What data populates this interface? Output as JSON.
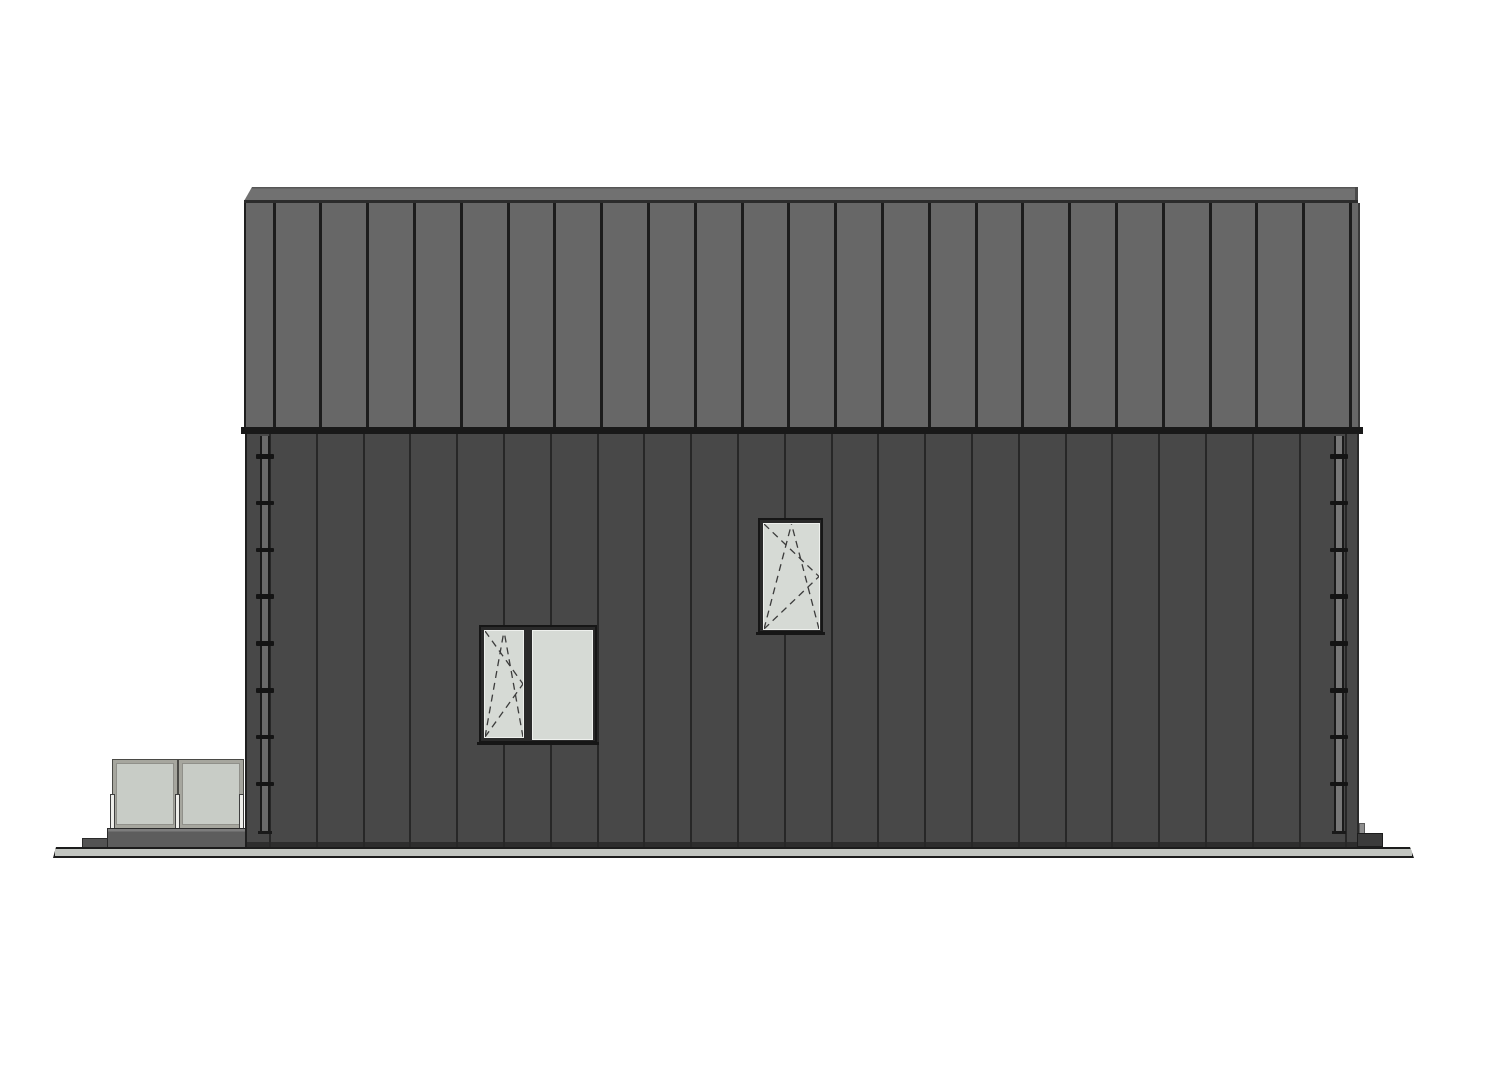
{
  "drawing": {
    "kind": "building-side-elevation",
    "palette": {
      "background": "#ffffff",
      "roof_panel": "#676767",
      "roof_fascia": "#717171",
      "eave_trim": "#191919",
      "wall_cladding": "#484848",
      "seam_line": "#1c1c1c",
      "board_line": "#272727",
      "window_frame": "#2a2a2a",
      "window_glass": "#d6dad5",
      "railing_glass": "#c8ccc6",
      "railing_frame": "#a6a69e",
      "plinth": "#5d5d5d",
      "ground_fill": "#c2c5c0",
      "outline": "#1c1c1c"
    },
    "roof": {
      "seam_count": 24,
      "first_seam_offset": 28,
      "seam_spacing": 46.8
    },
    "wall": {
      "board_count": 24,
      "first_board_offset": 23,
      "board_spacing": 46.8
    },
    "downspouts": {
      "count": 2,
      "bracket_count": 8,
      "bracket_start_offset": 18,
      "bracket_spacing": 46.8
    },
    "windows": [
      {
        "name": "double-casement-window",
        "panes": 2,
        "opening": "tilt-turn-left-sash"
      },
      {
        "name": "tilt-turn-window",
        "panes": 1,
        "opening": "tilt-turn"
      }
    ],
    "railing": {
      "glass_panel_count": 2,
      "post_count": 3
    }
  }
}
